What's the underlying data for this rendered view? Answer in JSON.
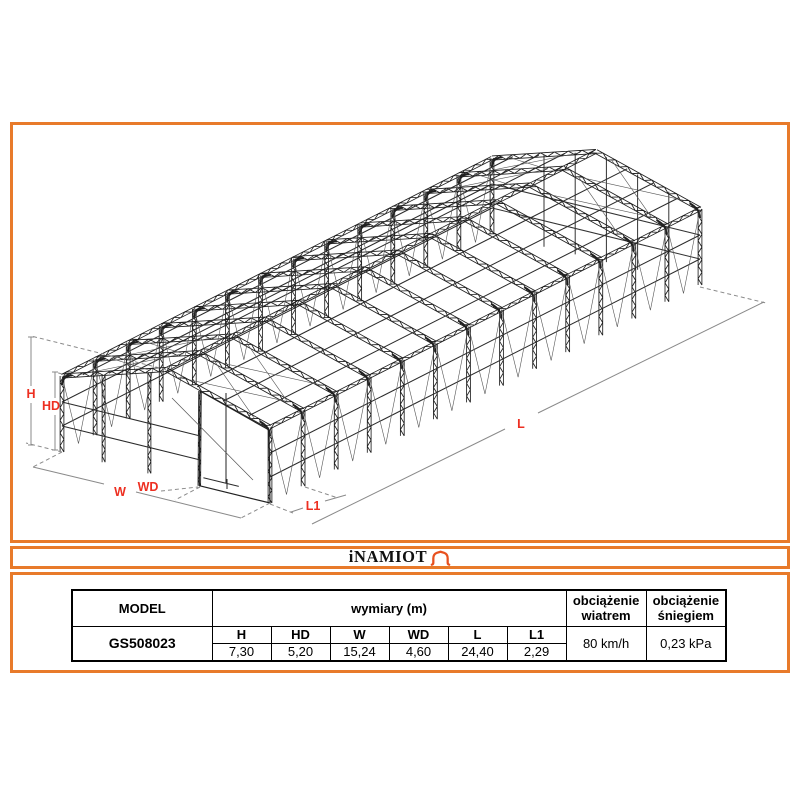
{
  "drawing": {
    "labels": {
      "h": "H",
      "hd": "HD",
      "w": "W",
      "wd": "WD",
      "l": "L",
      "l1": "L1"
    },
    "colors": {
      "frame_border_orange": "#e87a2a",
      "dimension_label_red": "#ed2f21",
      "structure_dark": "#1f1f1f",
      "logo_tent_orange": "#e8511f"
    }
  },
  "logo": {
    "brand": "iNAMIOT"
  },
  "spec_table": {
    "model_header": "MODEL",
    "model_value": "GS508023",
    "dimensions_header": "wymiary (m)",
    "wind_load_header": "obciążenie wiatrem",
    "snow_load_header": "obciążenie śniegiem",
    "dimensions": [
      {
        "label": "H",
        "value": "7,30"
      },
      {
        "label": "HD",
        "value": "5,20"
      },
      {
        "label": "W",
        "value": "15,24"
      },
      {
        "label": "WD",
        "value": "4,60"
      },
      {
        "label": "L",
        "value": "24,40"
      },
      {
        "label": "L1",
        "value": "2,29"
      }
    ],
    "wind_load_value": "80 km/h",
    "snow_load_value": "0,23 kPa"
  }
}
